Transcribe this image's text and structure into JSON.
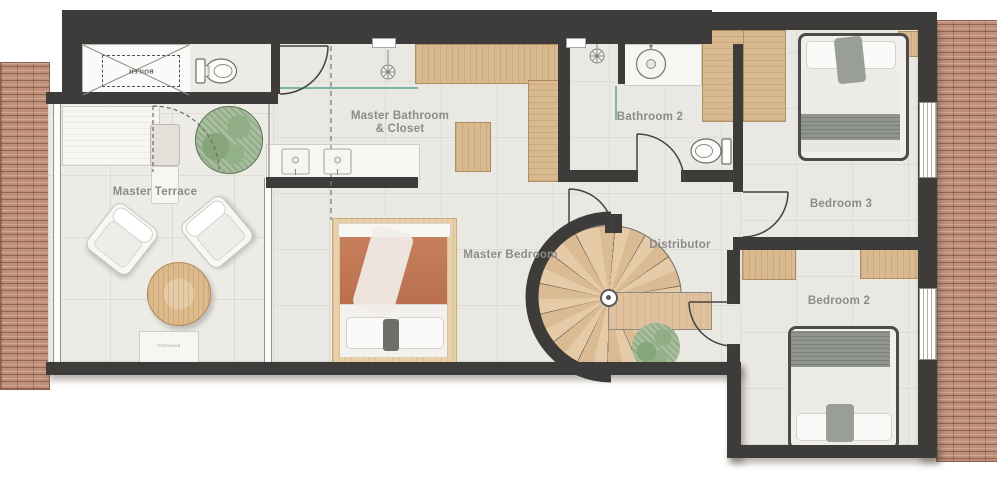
{
  "floorplan": {
    "rooms": {
      "master_terrace": {
        "label": "Master Terrace"
      },
      "master_bathroom_closet": {
        "label_line1": "Master Bathroom",
        "label_line2": "& Closet"
      },
      "master_bedroom": {
        "label": "Master Bedroom"
      },
      "bathroom_2": {
        "label": "Bathroom 2"
      },
      "distributor": {
        "label": "Distributor"
      },
      "bedroom_3": {
        "label": "Bedroom 3"
      },
      "bedroom_2": {
        "label": "Bedroom 2"
      }
    },
    "annotations": {
      "boiler": "BOILER",
      "terrace_fireplace": "Chimenea"
    },
    "symbols": [
      "spiral-staircase",
      "double-bed",
      "toilet",
      "washbasin",
      "double-vanity",
      "shower-head",
      "wardrobe",
      "closet",
      "armchair",
      "round-table",
      "potted-plant",
      "boiler-unit",
      "roof-tiles",
      "window",
      "door-swing",
      "glass-wall"
    ],
    "colors": {
      "wall": "#3e3c3b",
      "floor": "#eae8e2",
      "wood": "#d9b98f",
      "roof_tile": "#bf8f7a",
      "terracotta_bedding": "#c1795a",
      "plant_green": "#a3ba99",
      "glass_teal": "#7fb3a9",
      "label_text": "#8b8b89"
    }
  }
}
